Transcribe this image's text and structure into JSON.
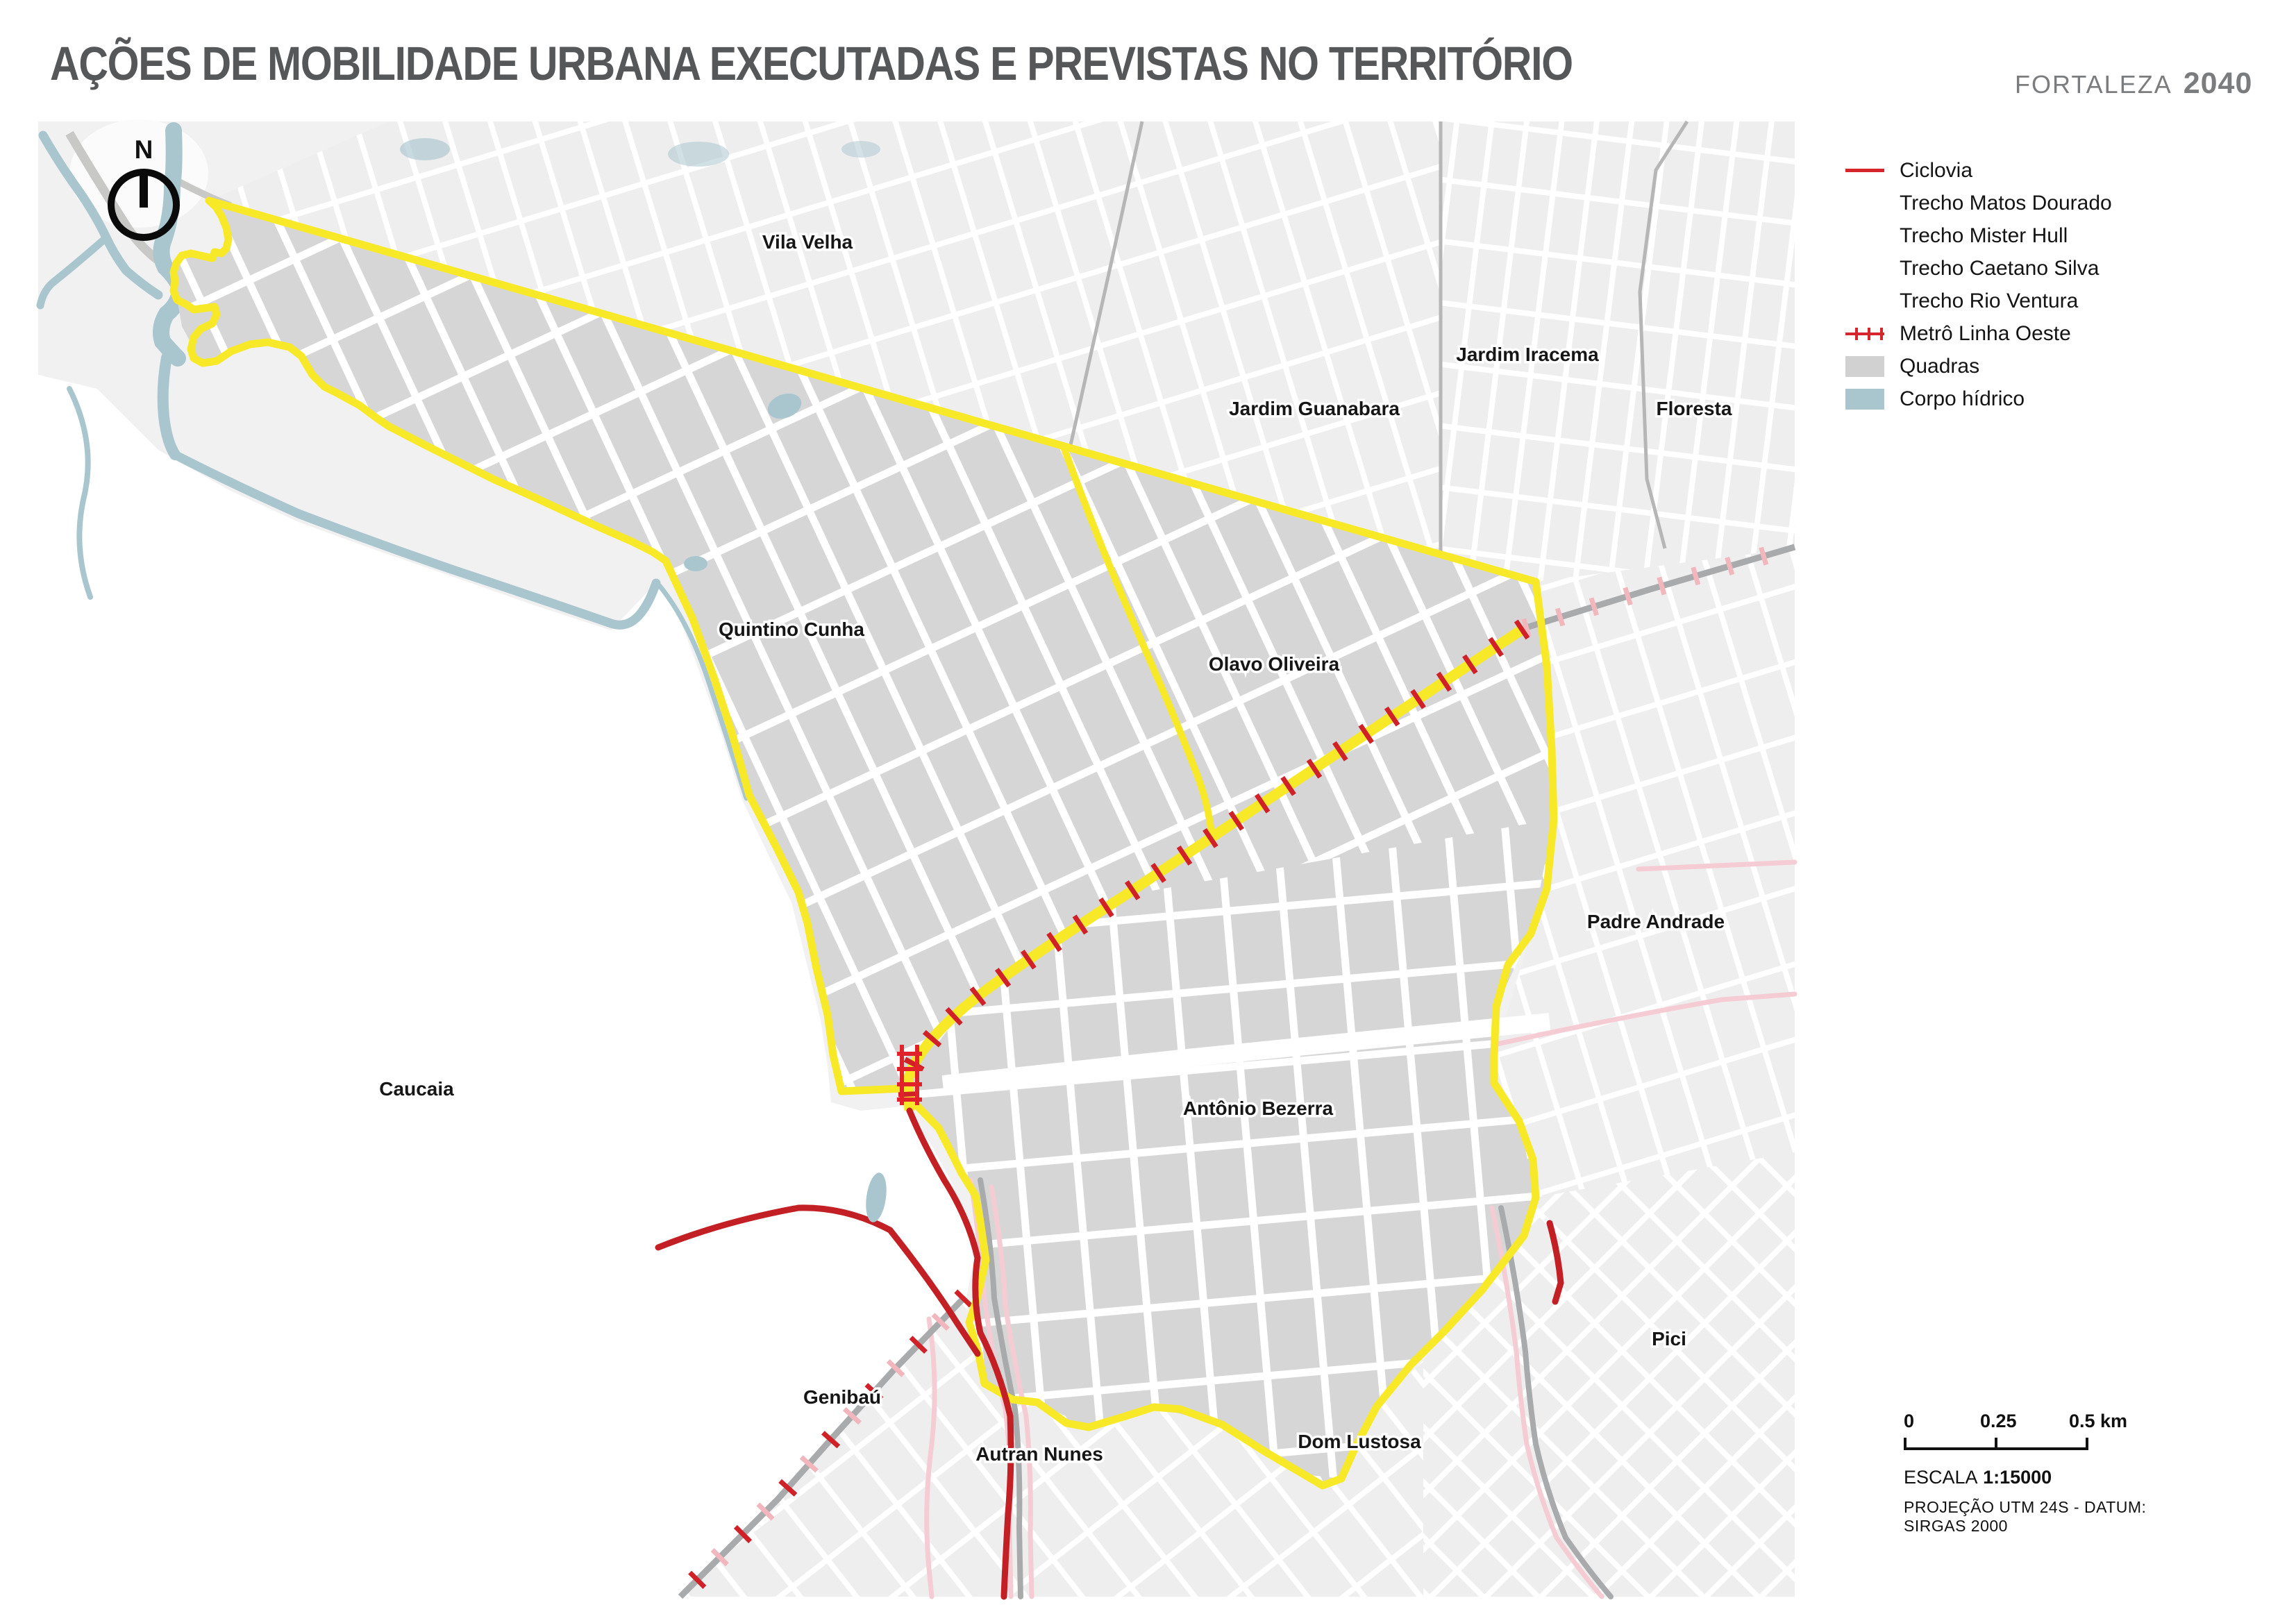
{
  "title": "AÇÕES DE MOBILIDADE URBANA EXECUTADAS E PREVISTAS NO TERRITÓRIO",
  "brand": {
    "name": "FORTALEZA",
    "year": "2040"
  },
  "north_indicator": "N",
  "legend": {
    "items": [
      {
        "label": "Ciclovia",
        "swatch": "line-red"
      },
      {
        "label": "Trecho Matos Dourado",
        "swatch": "none"
      },
      {
        "label": "Trecho Mister Hull",
        "swatch": "none"
      },
      {
        "label": "Trecho Caetano Silva",
        "swatch": "none"
      },
      {
        "label": "Trecho Rio Ventura",
        "swatch": "none"
      },
      {
        "label": "Metrô Linha Oeste",
        "swatch": "metro"
      },
      {
        "label": "Quadras",
        "swatch": "square-gray"
      },
      {
        "label": "Corpo hídrico",
        "swatch": "square-blue"
      }
    ]
  },
  "map": {
    "labels": [
      {
        "name": "Vila Velha"
      },
      {
        "name": "Jardim Iracema"
      },
      {
        "name": "Jardim Guanabara"
      },
      {
        "name": "Floresta"
      },
      {
        "name": "Quintino Cunha"
      },
      {
        "name": "Olavo Oliveira"
      },
      {
        "name": "Padre Andrade"
      },
      {
        "name": "Caucaia"
      },
      {
        "name": "Antônio Bezerra"
      },
      {
        "name": "Pici"
      },
      {
        "name": "Genibaú"
      },
      {
        "name": "Autran Nunes"
      },
      {
        "name": "Dom Lustosa"
      }
    ]
  },
  "scale_bar": {
    "tick0": "0",
    "tick1": "0.25",
    "tick2": "0.5 km",
    "escala_label": "ESCALA",
    "escala_value": "1:15000",
    "projection": "PROJEÇÃO UTM 24S - DATUM: SIRGAS 2000"
  },
  "colors": {
    "quadras_gray": "#d7d6d6",
    "outside_gray": "#efeeee",
    "boundary_yellow": "#f7e927",
    "ciclovia_red": "#c32026",
    "metro_red": "#d6252c",
    "water_blue": "#a9c6cf",
    "railway_gray": "#a8aaac",
    "pink_road": "#f5ccd3",
    "title_gray": "#565759"
  }
}
